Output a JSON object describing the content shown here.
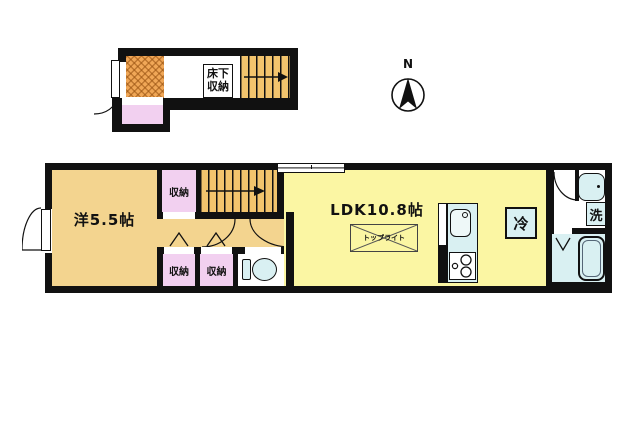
{
  "compass": {
    "label": "N"
  },
  "upper_floor": {
    "underfloor_storage_label": "床下収納"
  },
  "main_floor": {
    "western_room_label": "洋5.5帖",
    "ldk_label": "LDK10.8帖",
    "skylight_label": "トップライト",
    "fridge_label": "冷",
    "laundry_label": "洗",
    "closets": [
      "収納",
      "収納",
      "収納",
      "収納"
    ]
  },
  "colors": {
    "wall": "#111111",
    "western_room_and_hall": "#f3d48f",
    "ldk": "#fbf6a3",
    "stairs": "#f2c46d",
    "closet_pink": "#f2d0f0",
    "fixture_blue": "#d9f0f2",
    "entrance_checker": "#f0a757"
  }
}
